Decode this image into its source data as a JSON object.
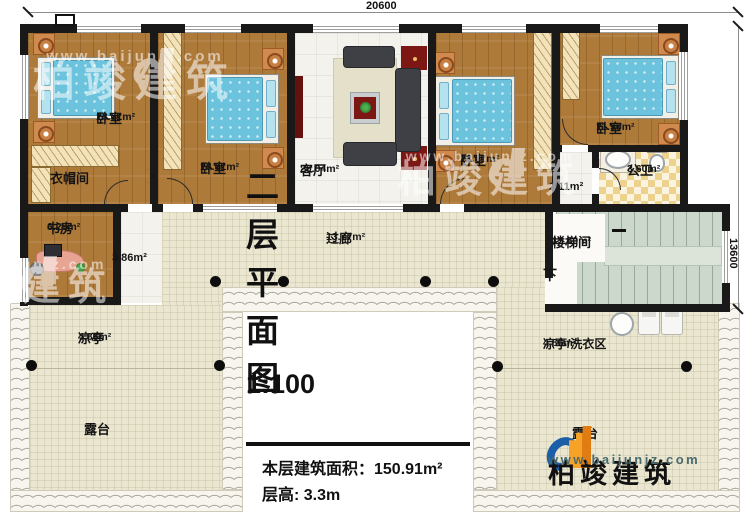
{
  "dimensions": {
    "top": "20600",
    "right": "13600"
  },
  "rooms": {
    "bedroom1": {
      "name": "卧室",
      "area": "18.01m²"
    },
    "bedroom2": {
      "name": "卧室",
      "area": "18.01m²"
    },
    "bedroom3": {
      "name": "卧室",
      "area": "18.01m²"
    },
    "bedroom4": {
      "name": "卧室",
      "area": "11.96m²"
    },
    "living": {
      "name": "客厅",
      "area": "20.04m²"
    },
    "cloakroom": {
      "name": "衣帽间"
    },
    "study": {
      "name": "书房",
      "area": "6.29m²"
    },
    "hall_small": {
      "area": "3.86m²"
    },
    "corridor": {
      "name": "过廊",
      "area": "13.77m²"
    },
    "stairwell": {
      "name": "楼梯间",
      "area": "13.80m²"
    },
    "stair_hall": {
      "area": "2.11m²"
    },
    "bathroom": {
      "name": "公卫",
      "area": "3.60m²"
    },
    "pavilion_left": {
      "name": "凉亭",
      "area": "4.86m²"
    },
    "pavilion_right": {
      "name": "凉亭/洗衣区",
      "area": "4.86m²"
    },
    "terrace_left": {
      "name": "露台"
    },
    "terrace_right": {
      "name": "露台"
    },
    "stair_down": {
      "label": "下"
    }
  },
  "title_block": {
    "title": "二层平面图",
    "scale": "1:100",
    "area_line": "本层建筑面积：150.91m²",
    "floor_height_line": "层高: 3.3m"
  },
  "watermark": {
    "brand": "柏竣建筑",
    "url": "www.baijunjz.com"
  },
  "logo": {
    "brand": "柏竣建筑",
    "url": "www.baijunjz.com"
  },
  "colors": {
    "wall": "#191919",
    "wood": "#ae7a3a",
    "beige": "#eae6d0",
    "stair_green": "#cdd8cd",
    "logo_blue": "#1c5fa8",
    "logo_orange": "#f08f1e",
    "url_teal": "#4a6a6e",
    "accent_red": "#7c1714"
  }
}
